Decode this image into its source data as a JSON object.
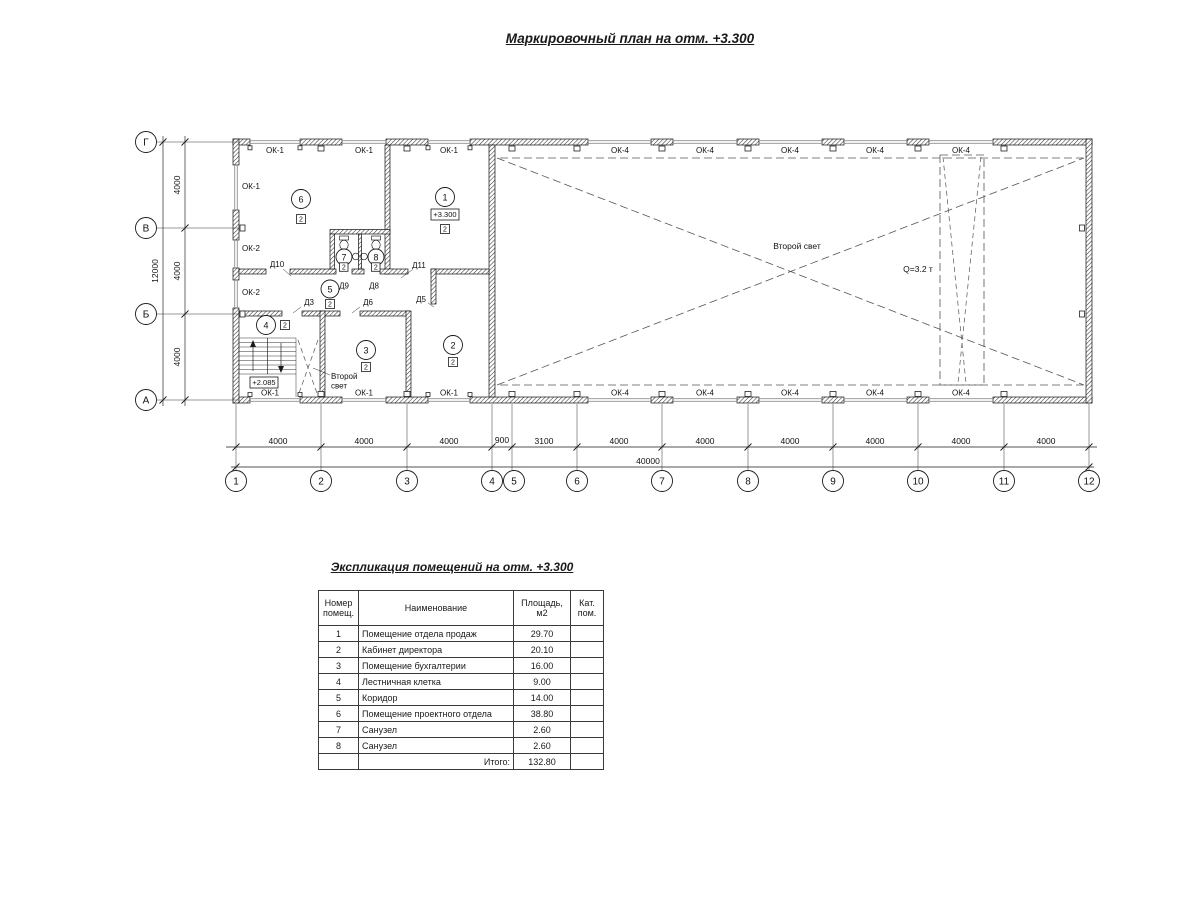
{
  "header": {
    "title": "Маркировочный план на отм. +3.300"
  },
  "plan": {
    "axes_cols": [
      "1",
      "2",
      "3",
      "4",
      "5",
      "6",
      "7",
      "8",
      "9",
      "10",
      "11",
      "12"
    ],
    "axes_rows": [
      "Г",
      "В",
      "Б",
      "А"
    ],
    "dims": [
      "4000",
      "4000",
      "4000",
      "900",
      "3100",
      "4000",
      "4000",
      "4000",
      "4000",
      "4000",
      "4000"
    ],
    "dim_total": "40000",
    "vdims": [
      "4000",
      "4000",
      "4000"
    ],
    "vdim_total": "12000",
    "win_top": [
      "ОК-1",
      "ОК-1",
      "ОК-1",
      "ОК-4",
      "ОК-4",
      "ОК-4",
      "ОК-4",
      "ОК-4"
    ],
    "win_bottom": [
      "ОК-1",
      "ОК-1",
      "ОК-1",
      "ОК-4",
      "ОК-4",
      "ОК-4",
      "ОК-4",
      "ОК-4"
    ],
    "win_left": [
      "ОК-1",
      "ОК-2",
      "ОК-2"
    ],
    "rooms": [
      {
        "num": "1",
        "cat": "2"
      },
      {
        "num": "2",
        "cat": "2"
      },
      {
        "num": "3",
        "cat": "2"
      },
      {
        "num": "4",
        "cat": "2"
      },
      {
        "num": "5",
        "cat": "2"
      },
      {
        "num": "6",
        "cat": "2"
      },
      {
        "num": "7",
        "cat": "2"
      },
      {
        "num": "8",
        "cat": "2"
      }
    ],
    "doors": {
      "d3": "Д3",
      "d5": "Д5",
      "d6": "Д6",
      "d8": "Д8",
      "d9": "Д9",
      "d10": "Д10",
      "d11": "Д11"
    },
    "labels": {
      "second_light": "Второй свет",
      "second_light_small_1": "Второй",
      "second_light_small_2": "свет",
      "crane": "Q=3.2 т",
      "level_first": "+3.300",
      "level_stair": "+2.085"
    }
  },
  "table": {
    "title": "Экспликация помещений на отм. +3.300",
    "headers": [
      "Номер помещ.",
      "Наименование",
      "Площадь, м2",
      "Кат. пом."
    ],
    "rows": [
      {
        "num": "1",
        "name": "Помещение отдела продаж",
        "area": "29.70",
        "cat": ""
      },
      {
        "num": "2",
        "name": "Кабинет директора",
        "area": "20.10",
        "cat": ""
      },
      {
        "num": "3",
        "name": "Помещение бухгалтерии",
        "area": "16.00",
        "cat": ""
      },
      {
        "num": "4",
        "name": "Лестничная клетка",
        "area": "9.00",
        "cat": ""
      },
      {
        "num": "5",
        "name": "Коридор",
        "area": "14.00",
        "cat": ""
      },
      {
        "num": "6",
        "name": "Помещение проектного отдела",
        "area": "38.80",
        "cat": ""
      },
      {
        "num": "7",
        "name": "Санузел",
        "area": "2.60",
        "cat": ""
      },
      {
        "num": "8",
        "name": "Санузел",
        "area": "2.60",
        "cat": ""
      }
    ],
    "total_label": "Итого:",
    "total_value": "132.80"
  }
}
